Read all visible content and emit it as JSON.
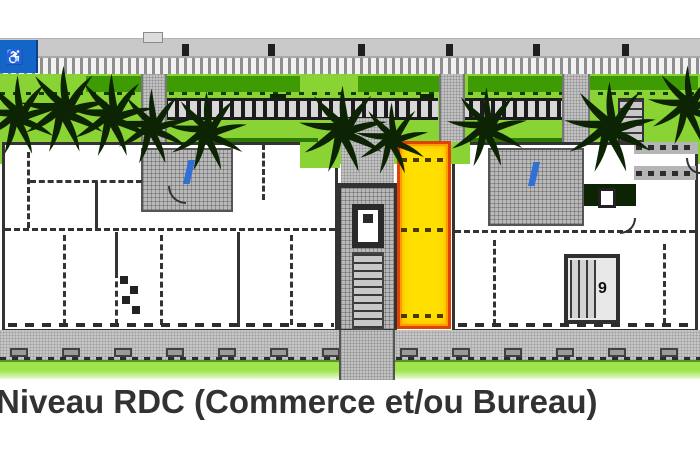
{
  "plan": {
    "caption": "Niveau RDC (Commerce et/ou Bureau)",
    "stair_label": "9",
    "handicap_symbol": "♿"
  },
  "colors": {
    "unit_fill": "#ffdf00",
    "unit_border": "#e24200",
    "lawn": "#8ad335",
    "hedge": "#3e9b04",
    "strip_green": "#9fe44d",
    "road": "#c9c9c9",
    "sidewalk": "#c6c6c6",
    "wall": "#333333",
    "handicap_blue": "#1465c8",
    "stair_icon_blue": "#2f6fd6",
    "caption": "#323232"
  }
}
